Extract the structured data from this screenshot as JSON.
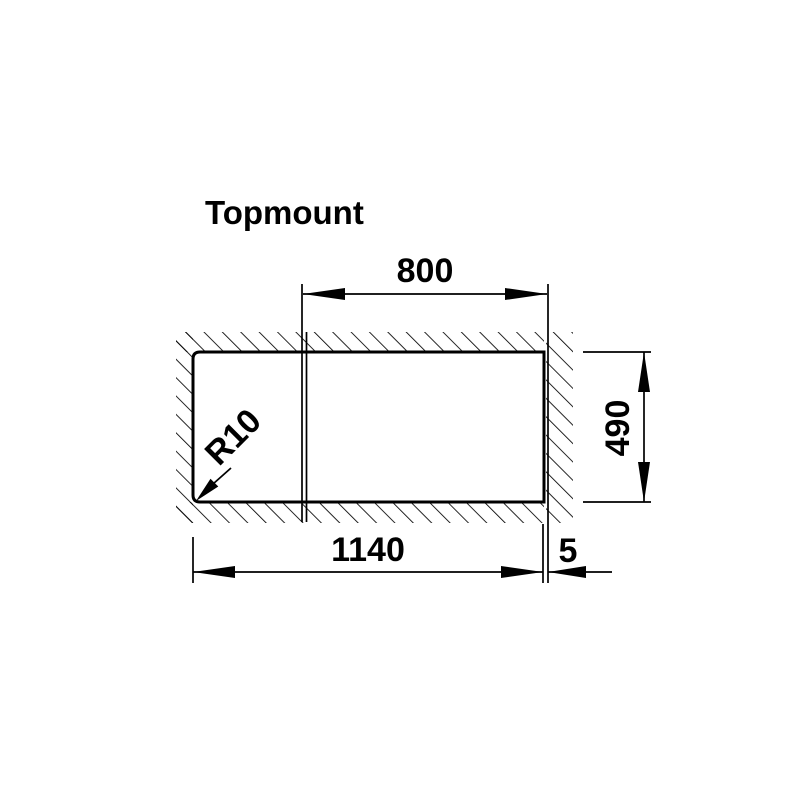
{
  "title": "Topmount",
  "diagram": {
    "type": "technical-installation-drawing",
    "subject": "sink-cutout-plan-view",
    "labels": {
      "top_width": "800",
      "side_height": "490",
      "bottom_width": "1140",
      "edge_gap": "5",
      "corner_radius": "R10"
    },
    "colors": {
      "line": "#000000",
      "background": "#ffffff"
    }
  }
}
